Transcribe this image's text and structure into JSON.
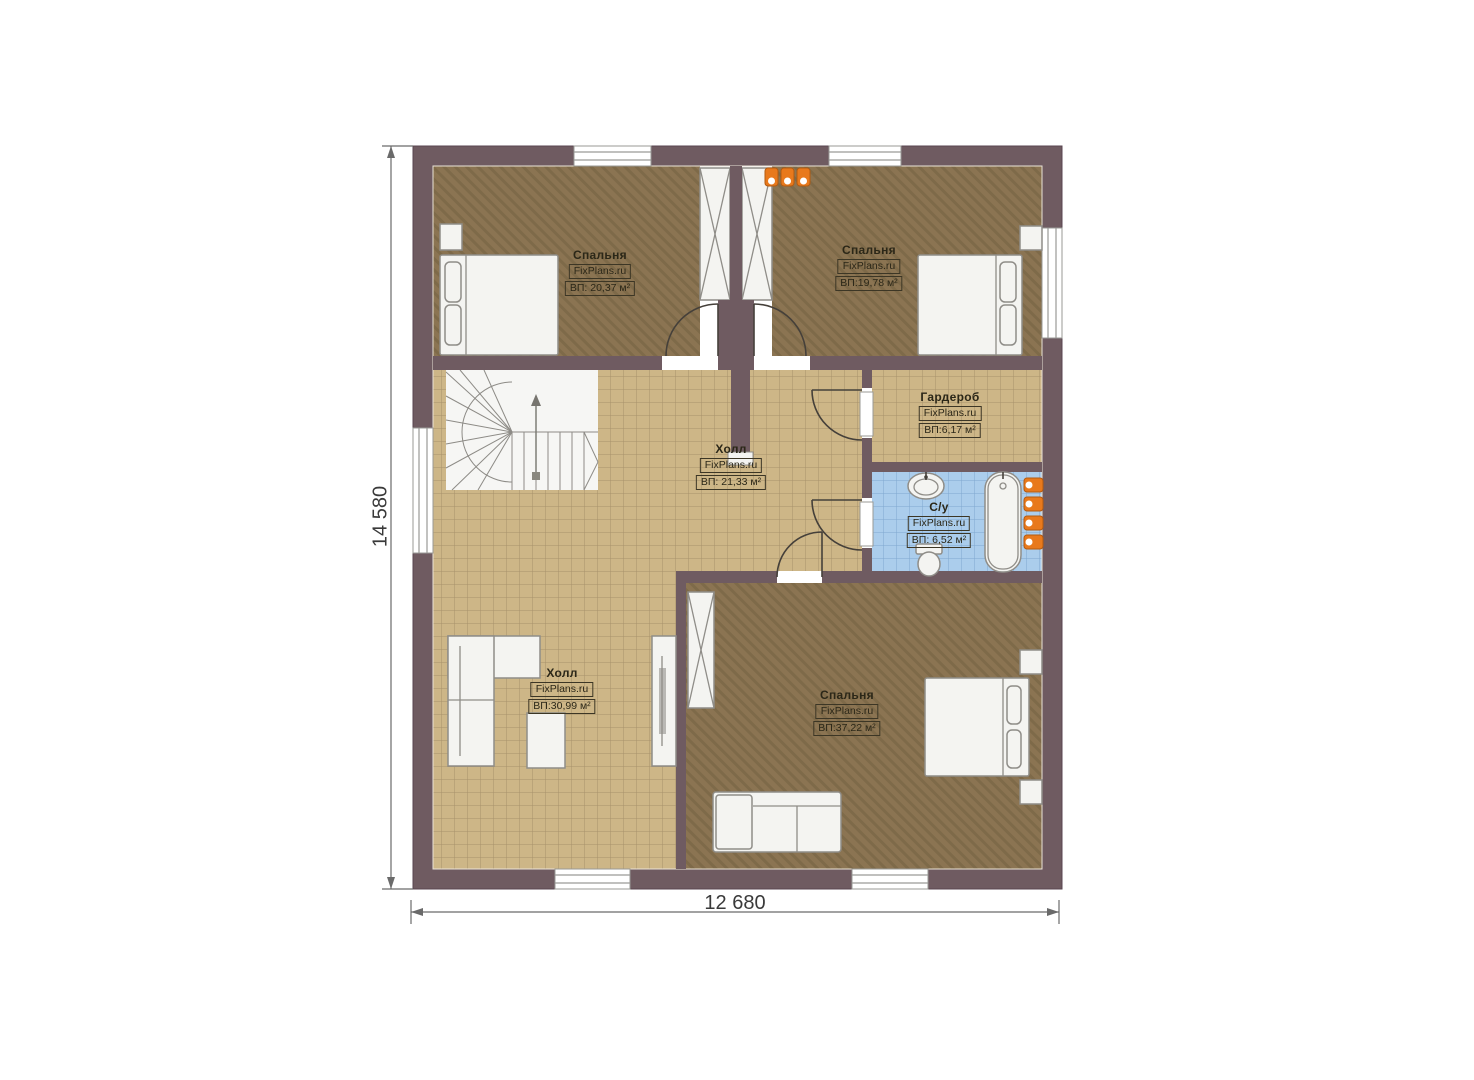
{
  "plan": {
    "brand": "FixPlans.ru",
    "rooms": [
      {
        "name": "Спальня",
        "brand": "FixPlans.ru",
        "area": "ВП: 20,37 м²"
      },
      {
        "name": "Спальня",
        "brand": "FixPlans.ru",
        "area": "ВП:19,78 м²"
      },
      {
        "name": "Гардероб",
        "brand": "FixPlans.ru",
        "area": "ВП:6,17 м²"
      },
      {
        "name": "Холл",
        "brand": "FixPlans.ru",
        "area": "ВП: 21,33 м²"
      },
      {
        "name": "С/у",
        "brand": "FixPlans.ru",
        "area": "ВП: 6,52 м²"
      },
      {
        "name": "Холл",
        "brand": "FixPlans.ru",
        "area": "ВП:30,99 м²"
      },
      {
        "name": "Спальня",
        "brand": "FixPlans.ru",
        "area": "ВП:37,22 м²"
      }
    ],
    "dimensions": {
      "height": "14 580",
      "width": "12 680"
    },
    "colors": {
      "wall": "#6f5b61",
      "bedroom_floor": "#8b7452",
      "hall_floor": "#cdb687",
      "bathroom_floor": "#abcdec",
      "furniture": "#f4f4f1",
      "radiator": "#e8791c",
      "dimension_text": "#3a3a3a"
    }
  }
}
